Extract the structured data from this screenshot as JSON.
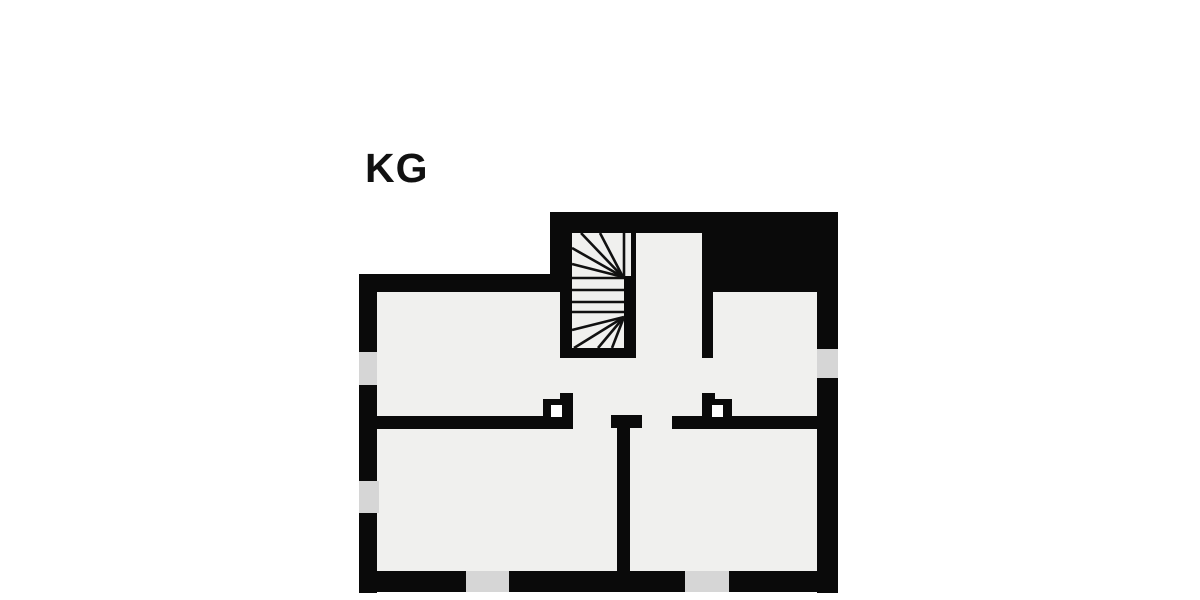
{
  "floorplan": {
    "label": "KG",
    "colors": {
      "background": "#ffffff",
      "wall": "#0a0a0a",
      "room_fill": "#f0f0ee",
      "opening_fill": "#d6d6d6",
      "stair_line": "#111111",
      "label_color": "#111111"
    },
    "features": {
      "staircase": "winder-staircase",
      "window_count": 3,
      "bottom_opening_count": 2,
      "chimney_count": 2
    }
  }
}
